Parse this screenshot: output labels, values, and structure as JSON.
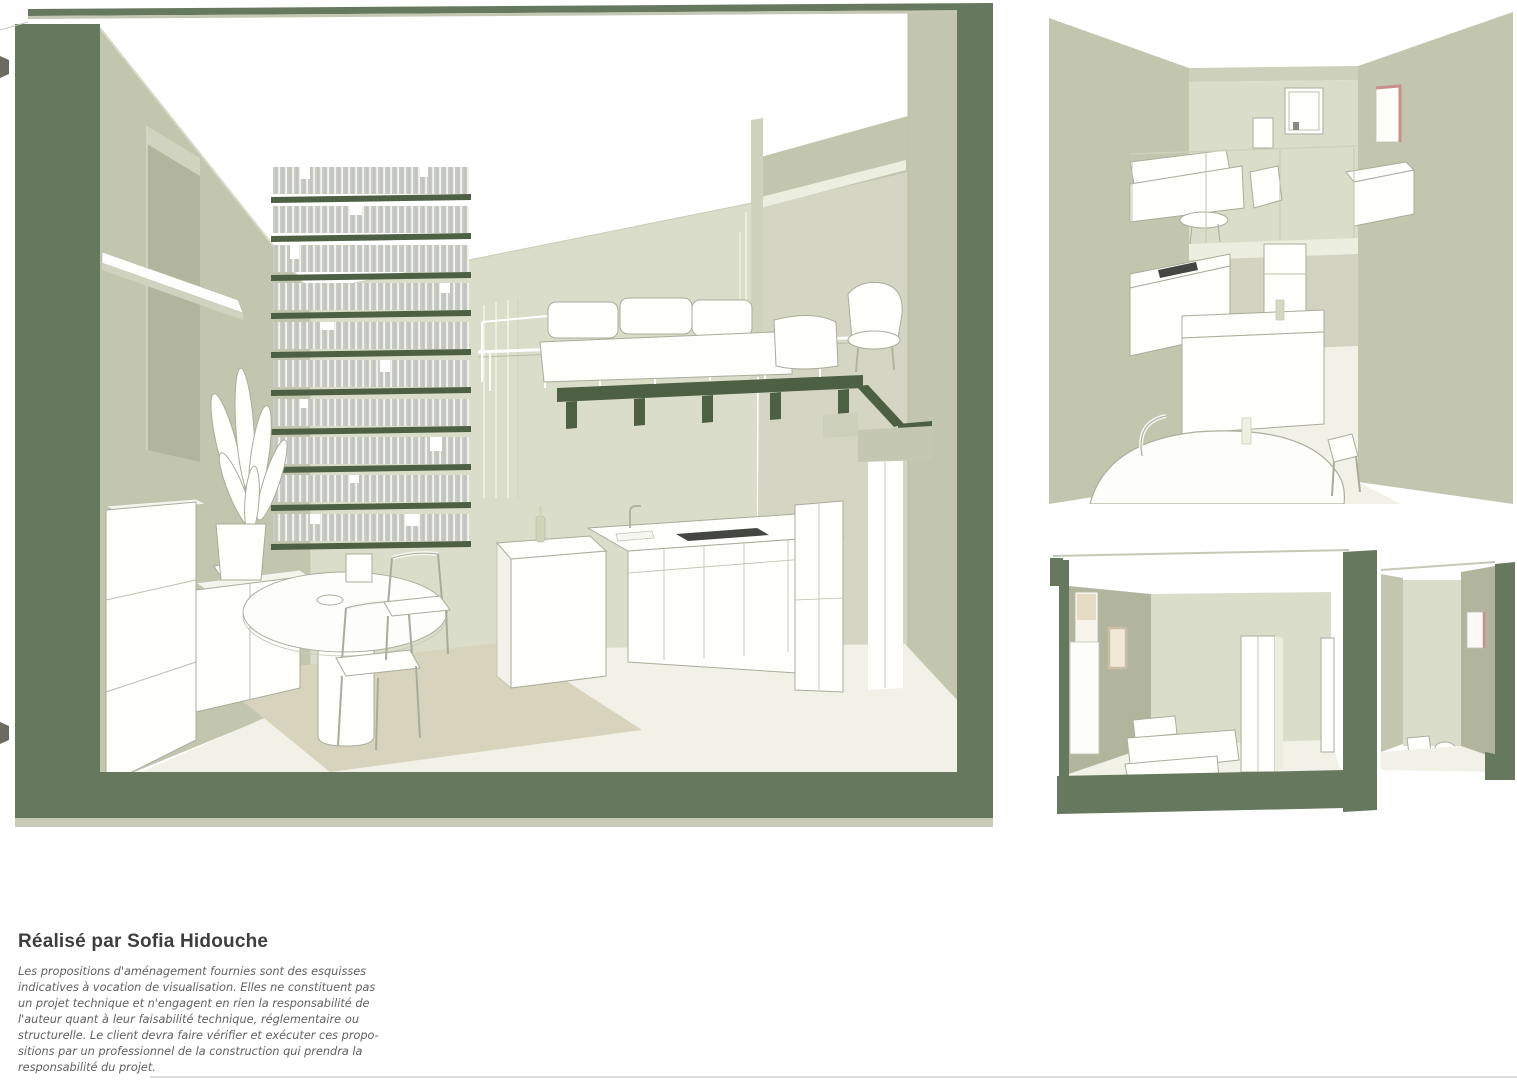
{
  "credit": {
    "title": "Réalisé par Sofia Hidouche",
    "disclaimer_lines": [
      "Les propositions d'aménagement fournies sont des esquisses",
      "indicatives à vocation de visualisation. Elles ne constituent pas",
      "un projet technique et n'engagent en rien la responsabilité de",
      "l'auteur quant à leur faisabilité technique, réglementaire ou",
      "structurelle. Le client devra faire vérifier et exécuter ces propo-",
      "sitions par un professionnel de la construction qui prendra la",
      "responsabilité du projet."
    ]
  },
  "colors": {
    "frame_green": "#66785e",
    "shelf_green": "#4d6044",
    "wall_olive": "#c3c6ae",
    "wall_olive_dark": "#b2b59e",
    "wall_light": "#dbddcb",
    "wall_side": "#cdd0ba",
    "wall_mid": "#d4d6c3",
    "floor_cream": "#f2f1e8",
    "rug_beige": "#d8d3bc",
    "book_gray": "#c9cbc5",
    "line_gray": "#a8ad9b",
    "stroke_light": "#bcc0ae",
    "window_pink": "#c98f88",
    "dark_fixture": "#43473f",
    "text_dark": "#3e3e3d",
    "text_gray": "#616161",
    "hairline": "#dcdcda"
  }
}
